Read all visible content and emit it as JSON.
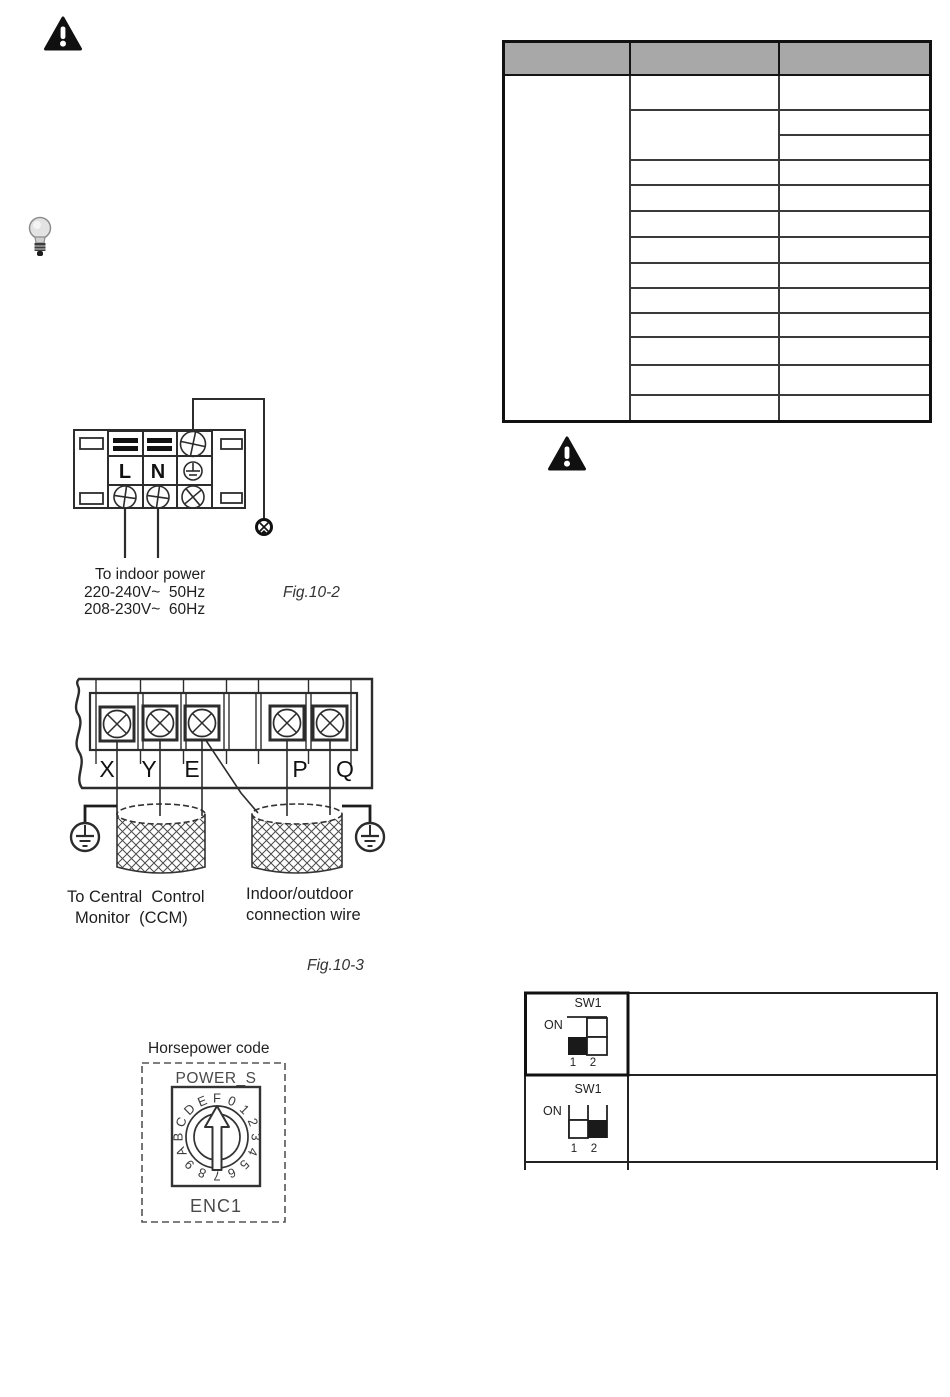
{
  "page": {
    "bg_color": "#ffffff"
  },
  "colors": {
    "header_gray": "#a8a8a8",
    "line_dark": "#2c2c2c",
    "switch_black": "#1a1a1a"
  },
  "spec_table": {
    "header_labels": [
      "",
      "",
      ""
    ],
    "body_rows": 13,
    "cells_empty": true
  },
  "fig2": {
    "labels": {
      "live": "L",
      "neutral": "N"
    },
    "caption": [
      "To indoor power",
      "220-240V~  50Hz",
      "208-230V~  60Hz"
    ],
    "fig_label": "Fig.10-2"
  },
  "fig3": {
    "terminals": [
      "X",
      "Y",
      "E",
      "P",
      "Q"
    ],
    "left_label": [
      "To Central  Control",
      "Monitor  (CCM)"
    ],
    "right_label": [
      "Indoor/outdoor",
      "connection wire"
    ],
    "fig_label": "Fig.10-3"
  },
  "horsepower": {
    "title": "Horsepower code",
    "chip": "POWER_S",
    "encoder": "ENC1",
    "dial": [
      "F",
      "0",
      "1",
      "2",
      "3",
      "4",
      "5",
      "6",
      "7",
      "8",
      "9",
      "A",
      "B",
      "C",
      "D",
      "E"
    ]
  },
  "dip": {
    "rows": [
      {
        "title": "SW1",
        "on": "ON",
        "pin1": "1",
        "pin2": "2",
        "black_switch": 1
      },
      {
        "title": "SW1",
        "on": "ON",
        "pin1": "1",
        "pin2": "2",
        "black_switch": 2
      }
    ]
  }
}
